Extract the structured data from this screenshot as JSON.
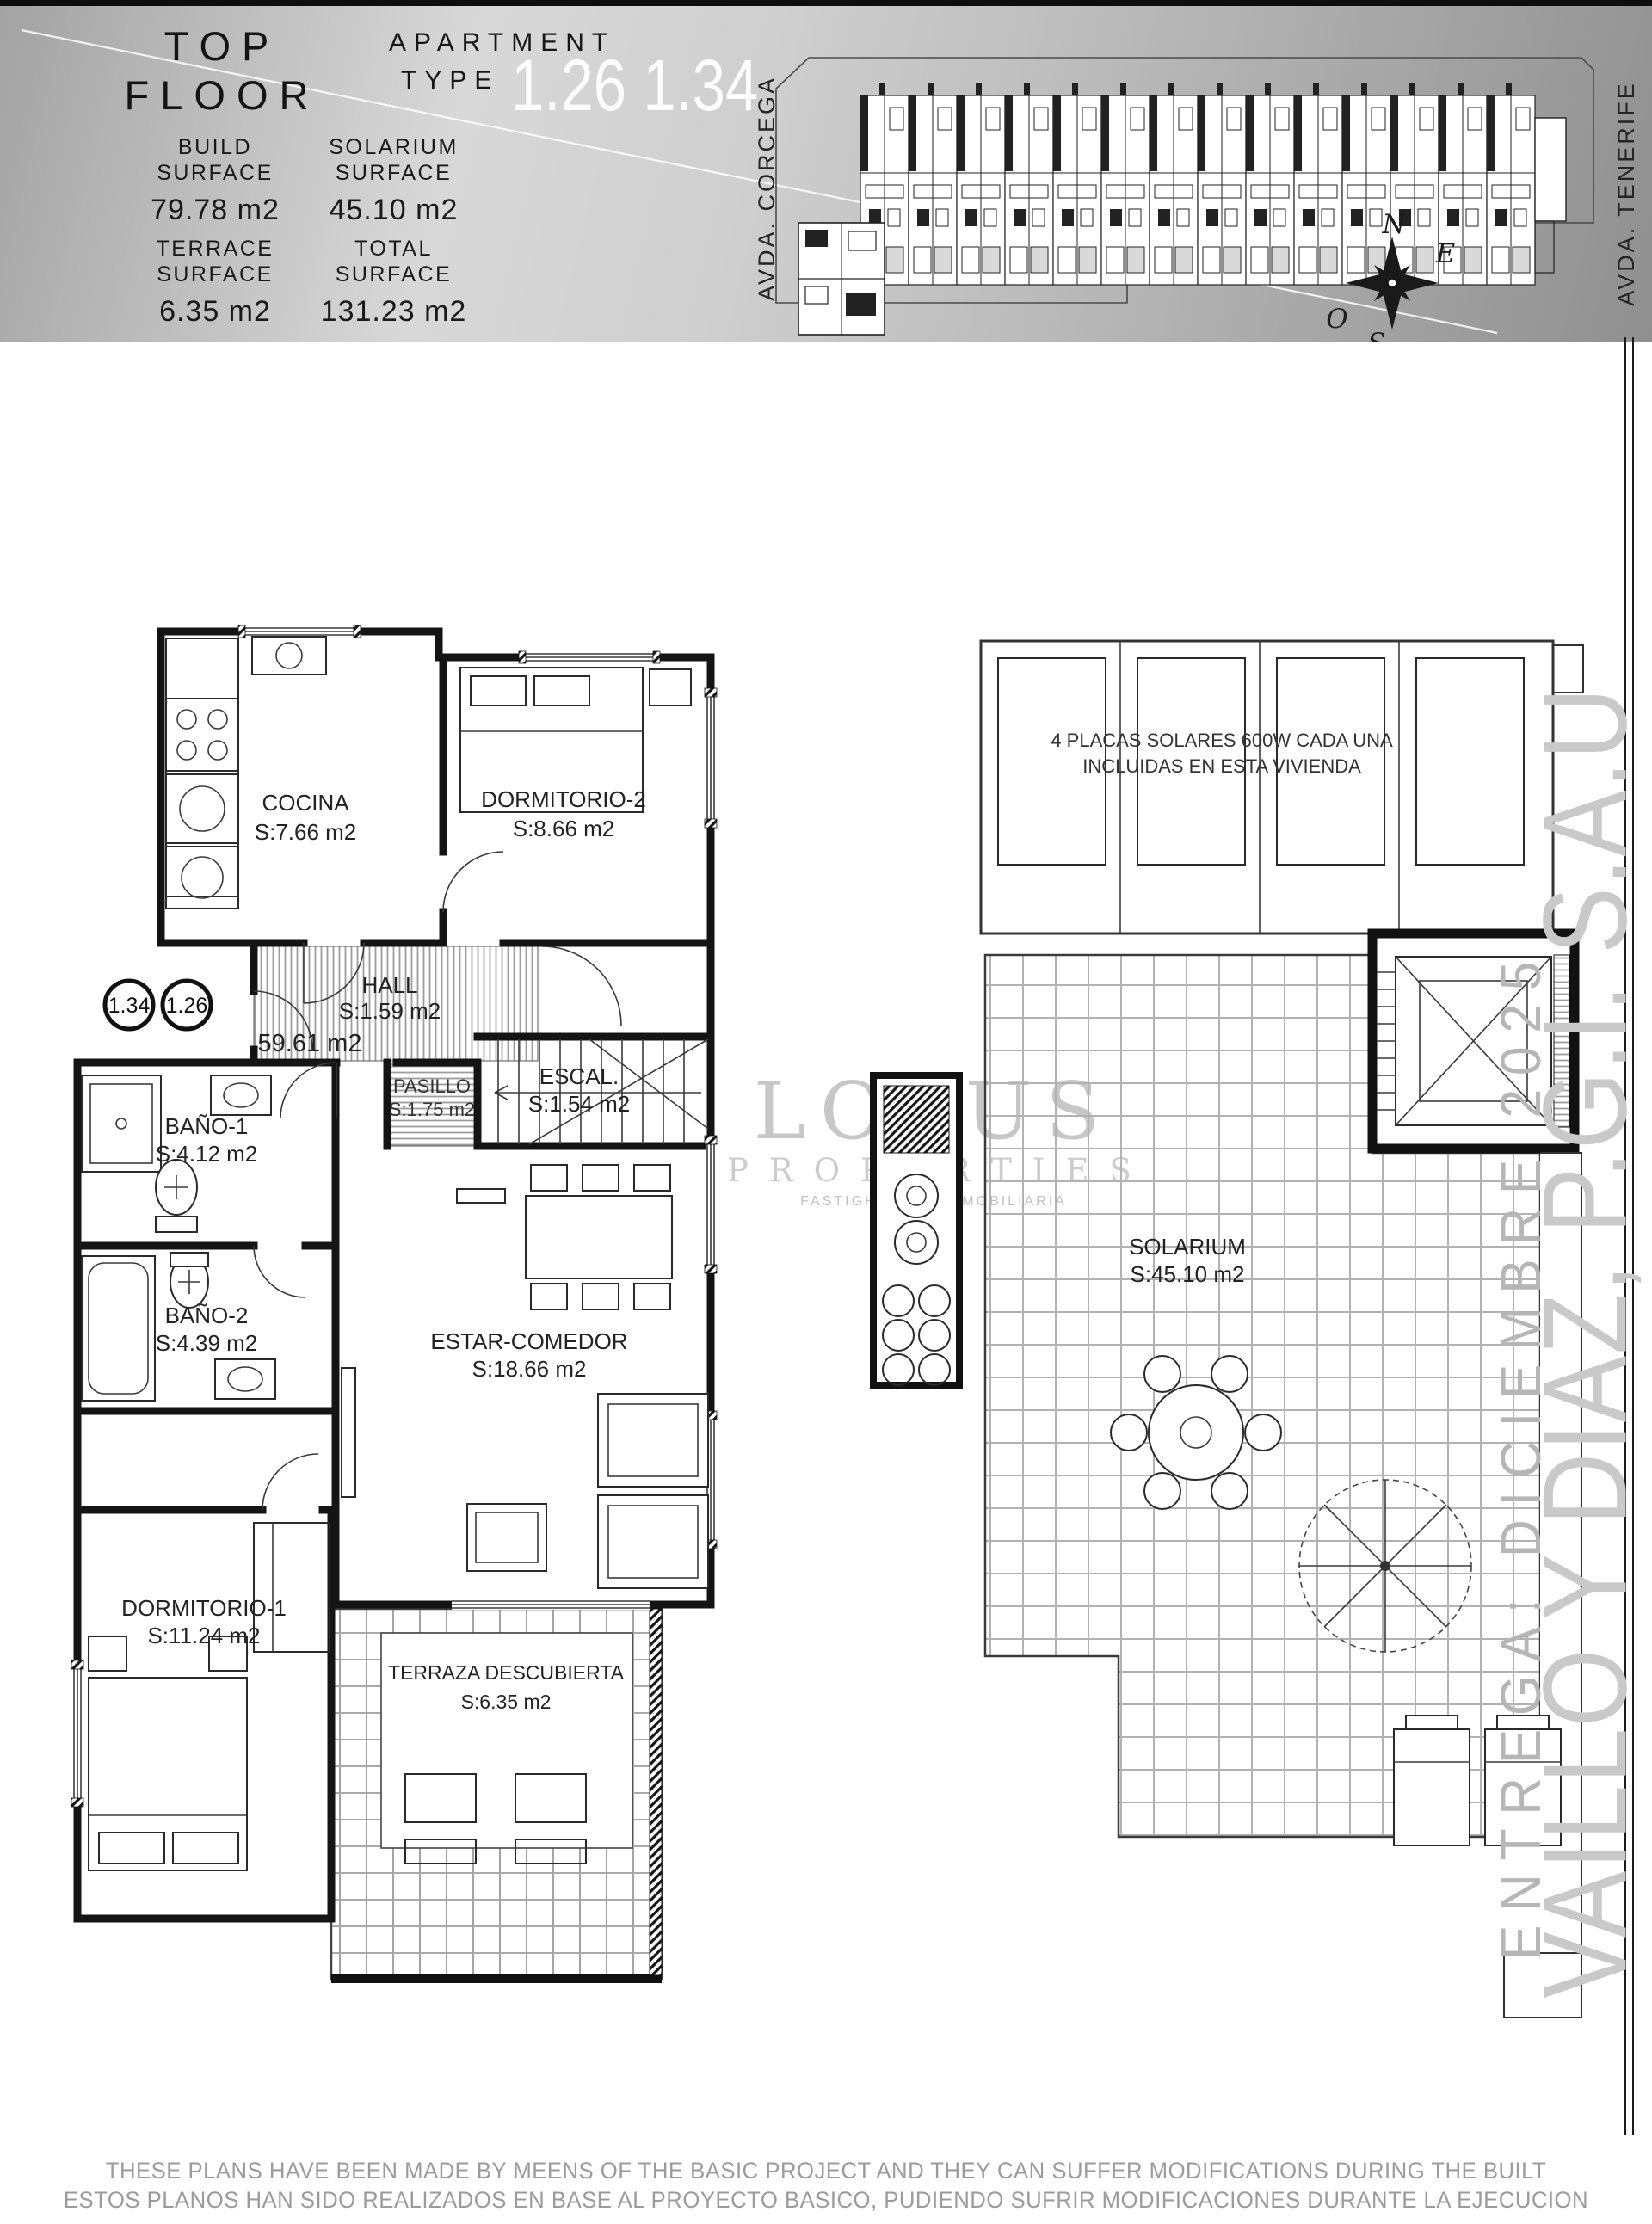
{
  "header": {
    "title_top": "TOP",
    "title_bottom": "FLOOR",
    "apartment_line1": "APARTMENT",
    "apartment_line2": "TYPE",
    "apartment_numbers": "1.26 1.34",
    "stats": [
      {
        "label1": "BUILD",
        "label2": "SURFACE",
        "value": "79.78 m2"
      },
      {
        "label1": "SOLARIUM",
        "label2": "SURFACE",
        "value": "45.10 m2"
      },
      {
        "label1": "TERRACE",
        "label2": "SURFACE",
        "value": "6.35 m2"
      },
      {
        "label1": "TOTAL",
        "label2": "SURFACE",
        "value": "131.23 m2"
      }
    ],
    "site": {
      "street_left": "AVDA. CORCEGA",
      "street_right": "AVDA. TENERIFE",
      "compass": {
        "north": "N",
        "east": "E",
        "south": "S",
        "west": "O"
      }
    }
  },
  "badges": {
    "left": "1.34",
    "right": "1.26"
  },
  "plan": {
    "cocina": {
      "name": "COCINA",
      "area": "S:7.66 m2"
    },
    "dormitorio2": {
      "name": "DORMITORIO-2",
      "area": "S:8.66 m2"
    },
    "hall": {
      "name": "HALL",
      "area": "S:1.59 m2",
      "built": "59.61 m2"
    },
    "pasillo": {
      "name": "PASILLO",
      "area": "S:1.75 m2"
    },
    "escalera": {
      "name": "ESCAL.",
      "area": "S:1.54 m2"
    },
    "bano1": {
      "name": "BAÑO-1",
      "area": "S:4.12 m2"
    },
    "bano2": {
      "name": "BAÑO-2",
      "area": "S:4.39 m2"
    },
    "estar": {
      "name": "ESTAR-COMEDOR",
      "area": "S:18.66 m2"
    },
    "dormitorio1": {
      "name": "DORMITORIO-1",
      "area": "S:11.24 m2"
    },
    "terraza": {
      "name": "TERRAZA DESCUBIERTA",
      "area": "S:6.35 m2"
    }
  },
  "solarium": {
    "note1": "4 PLACAS SOLARES 600W CADA UNA",
    "note2": "INCLUIDAS EN ESTA VIVIENDA",
    "name": "SOLARIUM",
    "area": "S:45.10 m2"
  },
  "watermark": {
    "line1": "LOTUS",
    "line2": "PROPERTIES",
    "line3": "FASTIGHETER | INMOBILIARIA"
  },
  "margin": {
    "delivery": "ENTREGA: DICIEMBRE 2025",
    "developer": "VAILLO Y DIAZ, P.G.I. S.A.U"
  },
  "footer": {
    "line1": "THESE PLANS HAVE BEEN MADE BY MEENS OF THE BASIC PROJECT AND THEY CAN SUFFER MODIFICATIONS DURING THE BUILT",
    "line2": "ESTOS PLANOS HAN SIDO REALIZADOS EN BASE AL PROYECTO BASICO, PUDIENDO SUFRIR MODIFICACIONES DURANTE LA EJECUCION"
  }
}
